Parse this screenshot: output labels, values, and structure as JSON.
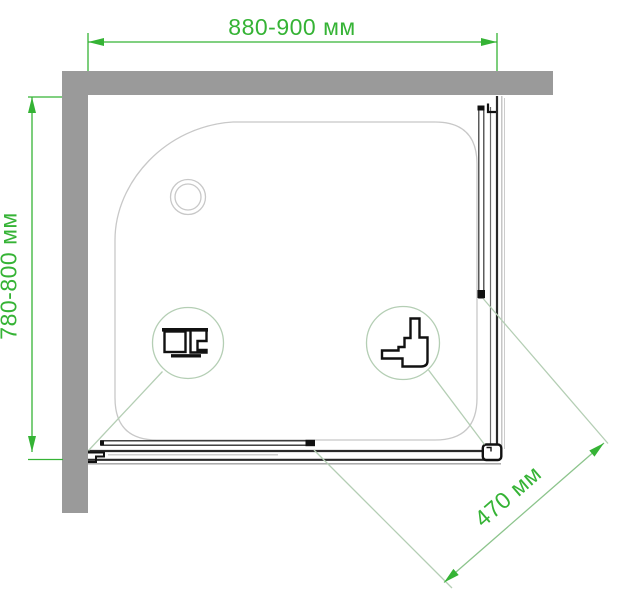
{
  "diagram": {
    "type": "shower-enclosure-top-view-technical-drawing",
    "labels": {
      "width": "880-900 мм",
      "depth": "780-800 мм",
      "door_opening": "470 мм"
    },
    "colors": {
      "dimension_green": "#35b335",
      "detail_pale_green": "#b4ceb4",
      "wall_gray": "#9a9a9a",
      "tray_outline": "#c8c8c8",
      "profile_black": "#111111"
    },
    "icons": [
      {
        "name": "drain-circle",
        "meaning": "shower tray drain"
      },
      {
        "name": "wall-profile-detail-icon",
        "meaning": "wall mounting profile cross-section"
      },
      {
        "name": "corner-profile-detail-icon",
        "meaning": "corner roller profile cross-section"
      }
    ]
  }
}
